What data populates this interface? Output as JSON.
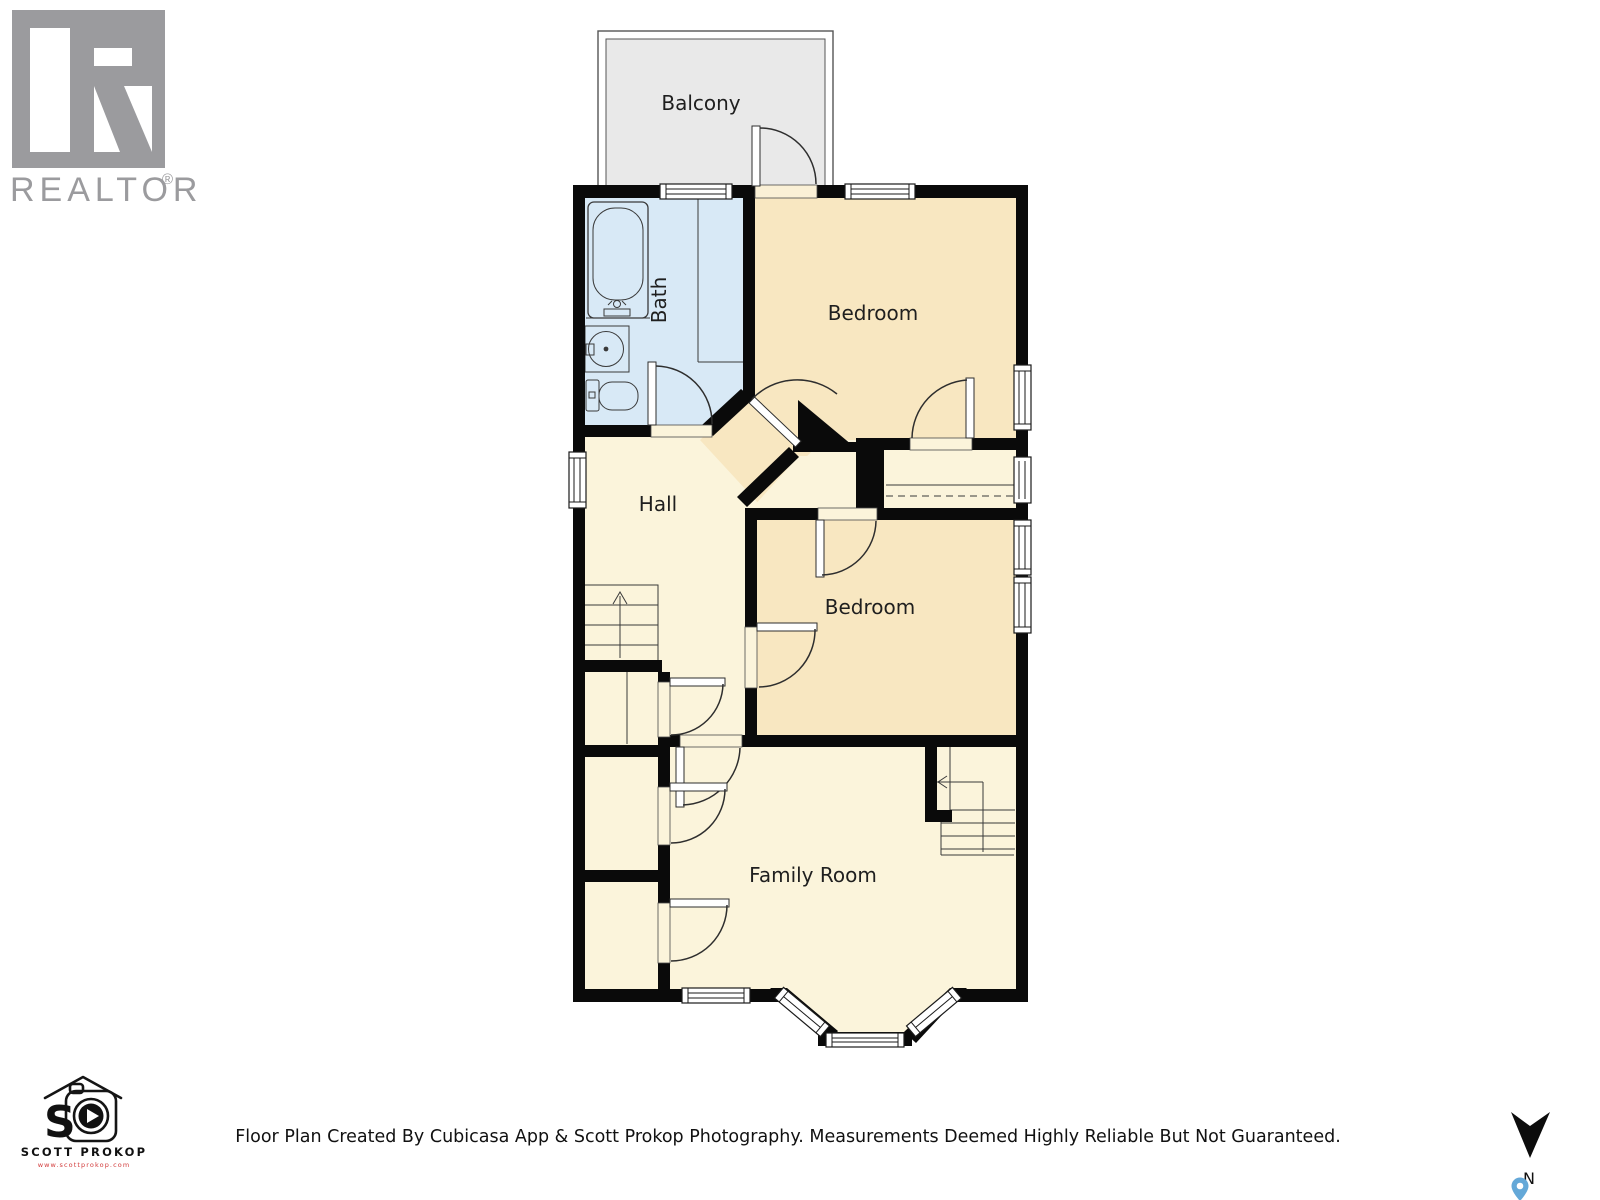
{
  "branding": {
    "realtor": {
      "label": "REALTOR",
      "registered": "®"
    },
    "photographer": {
      "initial": "S",
      "name": "SCOTT PROKOP",
      "website": "www.scottprokop.com"
    }
  },
  "floor_plan": {
    "rooms": [
      {
        "name": "Balcony"
      },
      {
        "name": "Bath"
      },
      {
        "name": "Bedroom"
      },
      {
        "name": "Hall"
      },
      {
        "name": "Bedroom"
      },
      {
        "name": "Family Room"
      }
    ]
  },
  "compass": {
    "north_label": "N"
  },
  "footer": {
    "disclaimer": "Floor Plan Created By Cubicasa App & Scott Prokop Photography. Measurements Deemed Highly Reliable But Not Guaranteed."
  },
  "colors": {
    "wall": "#0a0a0a",
    "bath_floor": "#d8e9f6",
    "bedroom_floor": "#f8e7c1",
    "hall_floor": "#fbf4db",
    "balcony_floor": "#e9e9e9",
    "logo_gray": "#9b9b9e",
    "pin_blue": "#64a8d8",
    "url_red": "#d23b3b"
  }
}
